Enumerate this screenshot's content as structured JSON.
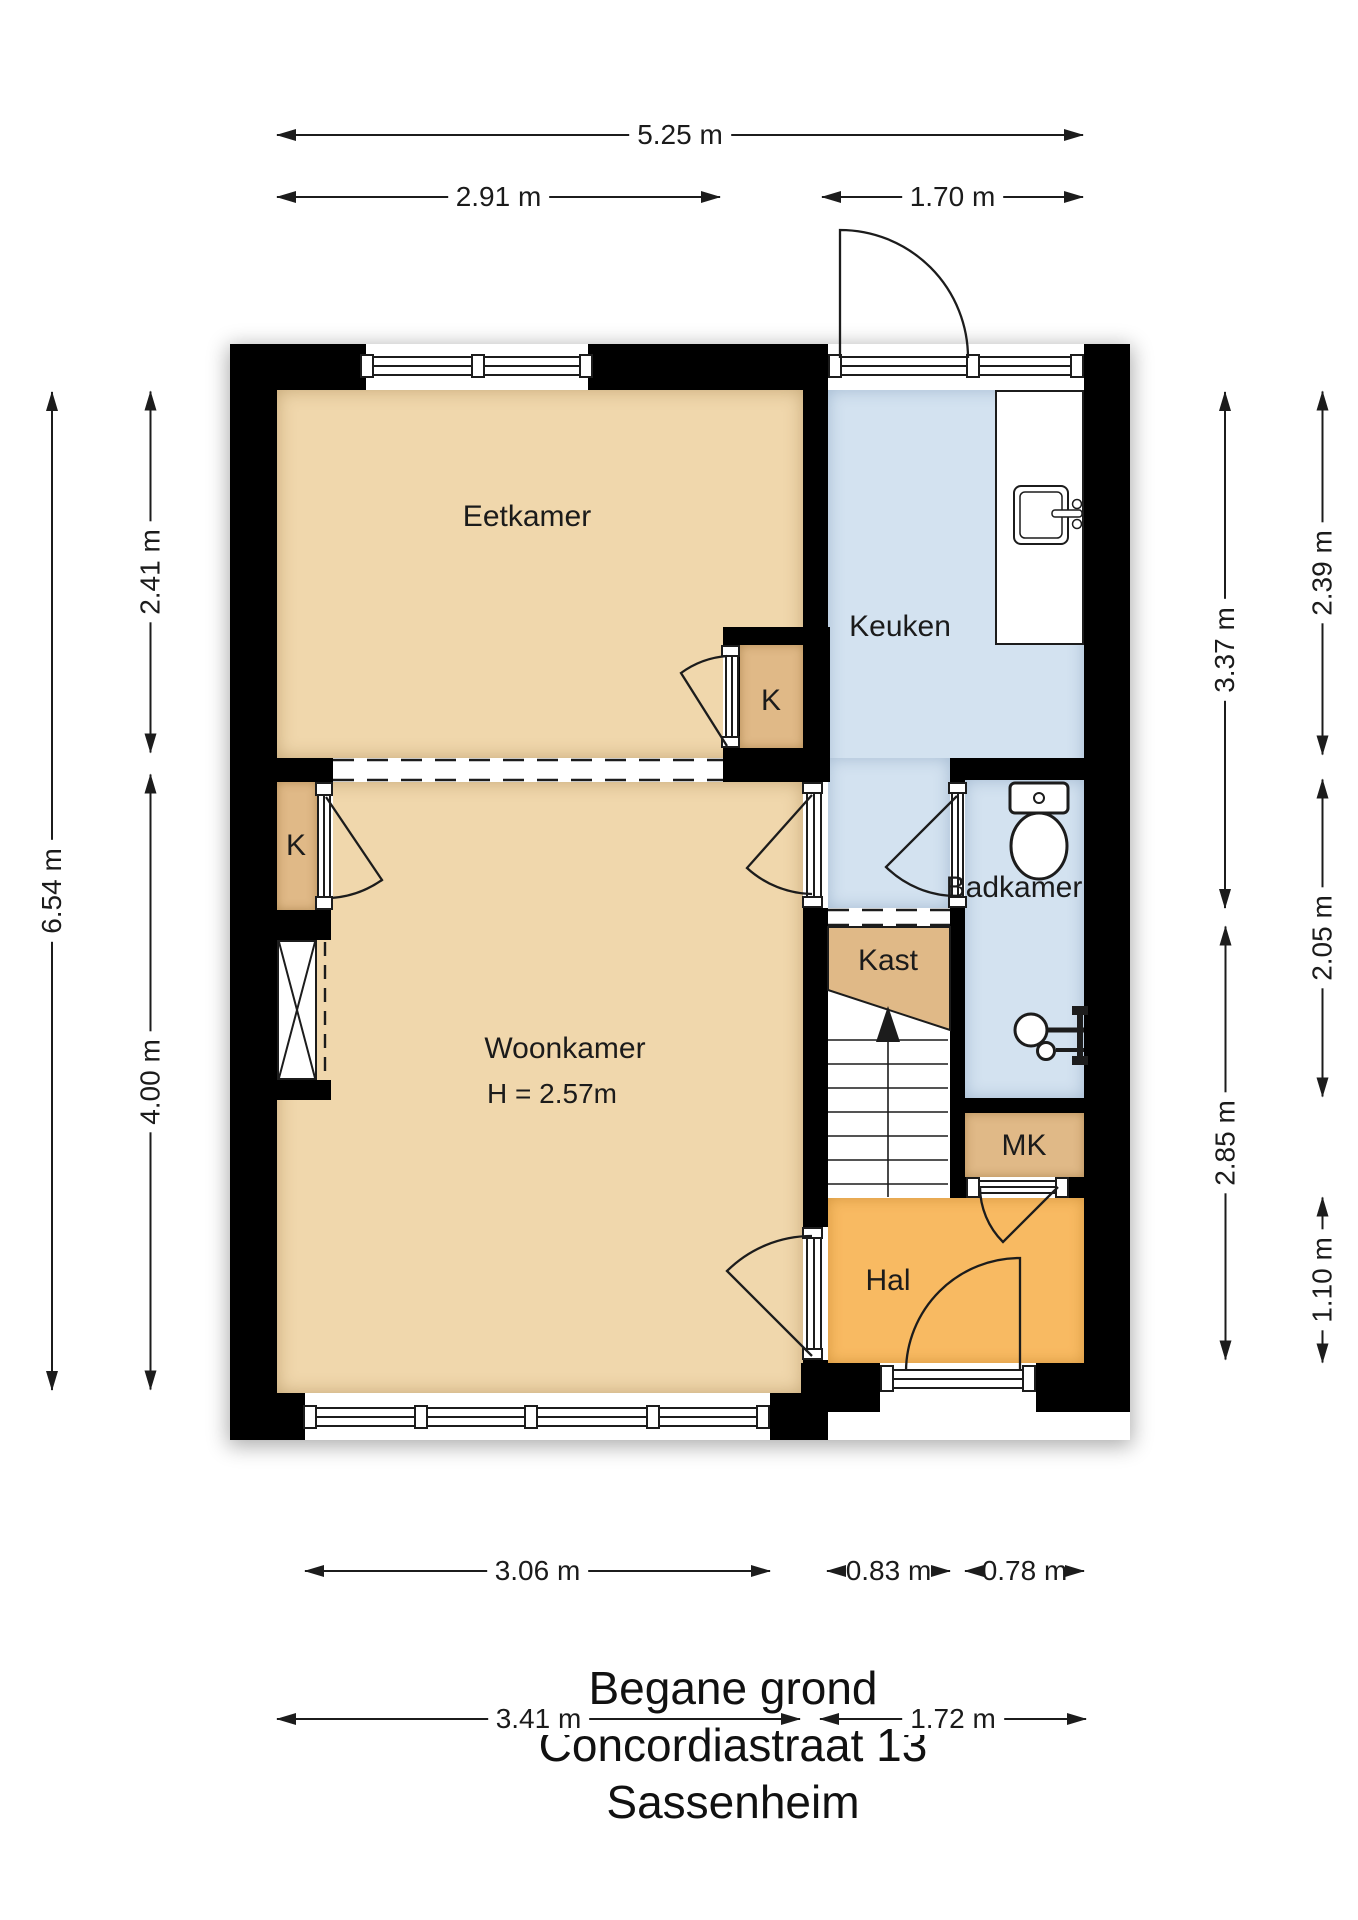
{
  "title": {
    "line1": "Begane grond",
    "line2": "Concordiastraat 13",
    "line3": "Sassenheim"
  },
  "rooms": {
    "eetkamer": {
      "label": "Eetkamer"
    },
    "keuken": {
      "label": "Keuken"
    },
    "woonkamer": {
      "label": "Woonkamer",
      "ceiling_height": "H = 2.57m"
    },
    "kast": {
      "label": "Kast"
    },
    "badkamer": {
      "label": "Badkamer"
    },
    "meterkast": {
      "label": "MK"
    },
    "hal": {
      "label": "Hal"
    },
    "closet_top": {
      "label": "K"
    },
    "closet_left": {
      "label": "K"
    }
  },
  "dimensions": {
    "top_total": "5.25 m",
    "top_left_section": "2.91 m",
    "top_right_section": "1.70 m",
    "left_total": "6.54 m",
    "left_upper": "2.41 m",
    "left_lower": "4.00 m",
    "right_inner_upper": "3.37 m",
    "right_inner_lower": "2.85 m",
    "right_outer_upper": "2.39 m",
    "right_outer_middle": "2.05 m",
    "right_outer_lower": "1.10 m",
    "bottom_window": "3.06 m",
    "bottom_mid_left": "0.83 m",
    "bottom_mid_right": "0.78 m",
    "bottom_left_total": "3.41 m",
    "bottom_right_total": "1.72 m"
  },
  "icons": {
    "toilet": "toilet-icon",
    "kitchen_sink": "kitchen-sink-icon",
    "shower": "shower-fixture-icon",
    "stairs_arrow": "stairs-up-arrow-icon"
  },
  "colors": {
    "wall": "#000000",
    "living_tan": "#f0d7ac",
    "closet_tan": "#e0b987",
    "wet_room_blue": "#d3e2f0",
    "hall_orange": "#f8ba62",
    "line": "#1c1c1c",
    "background": "#ffffff"
  }
}
